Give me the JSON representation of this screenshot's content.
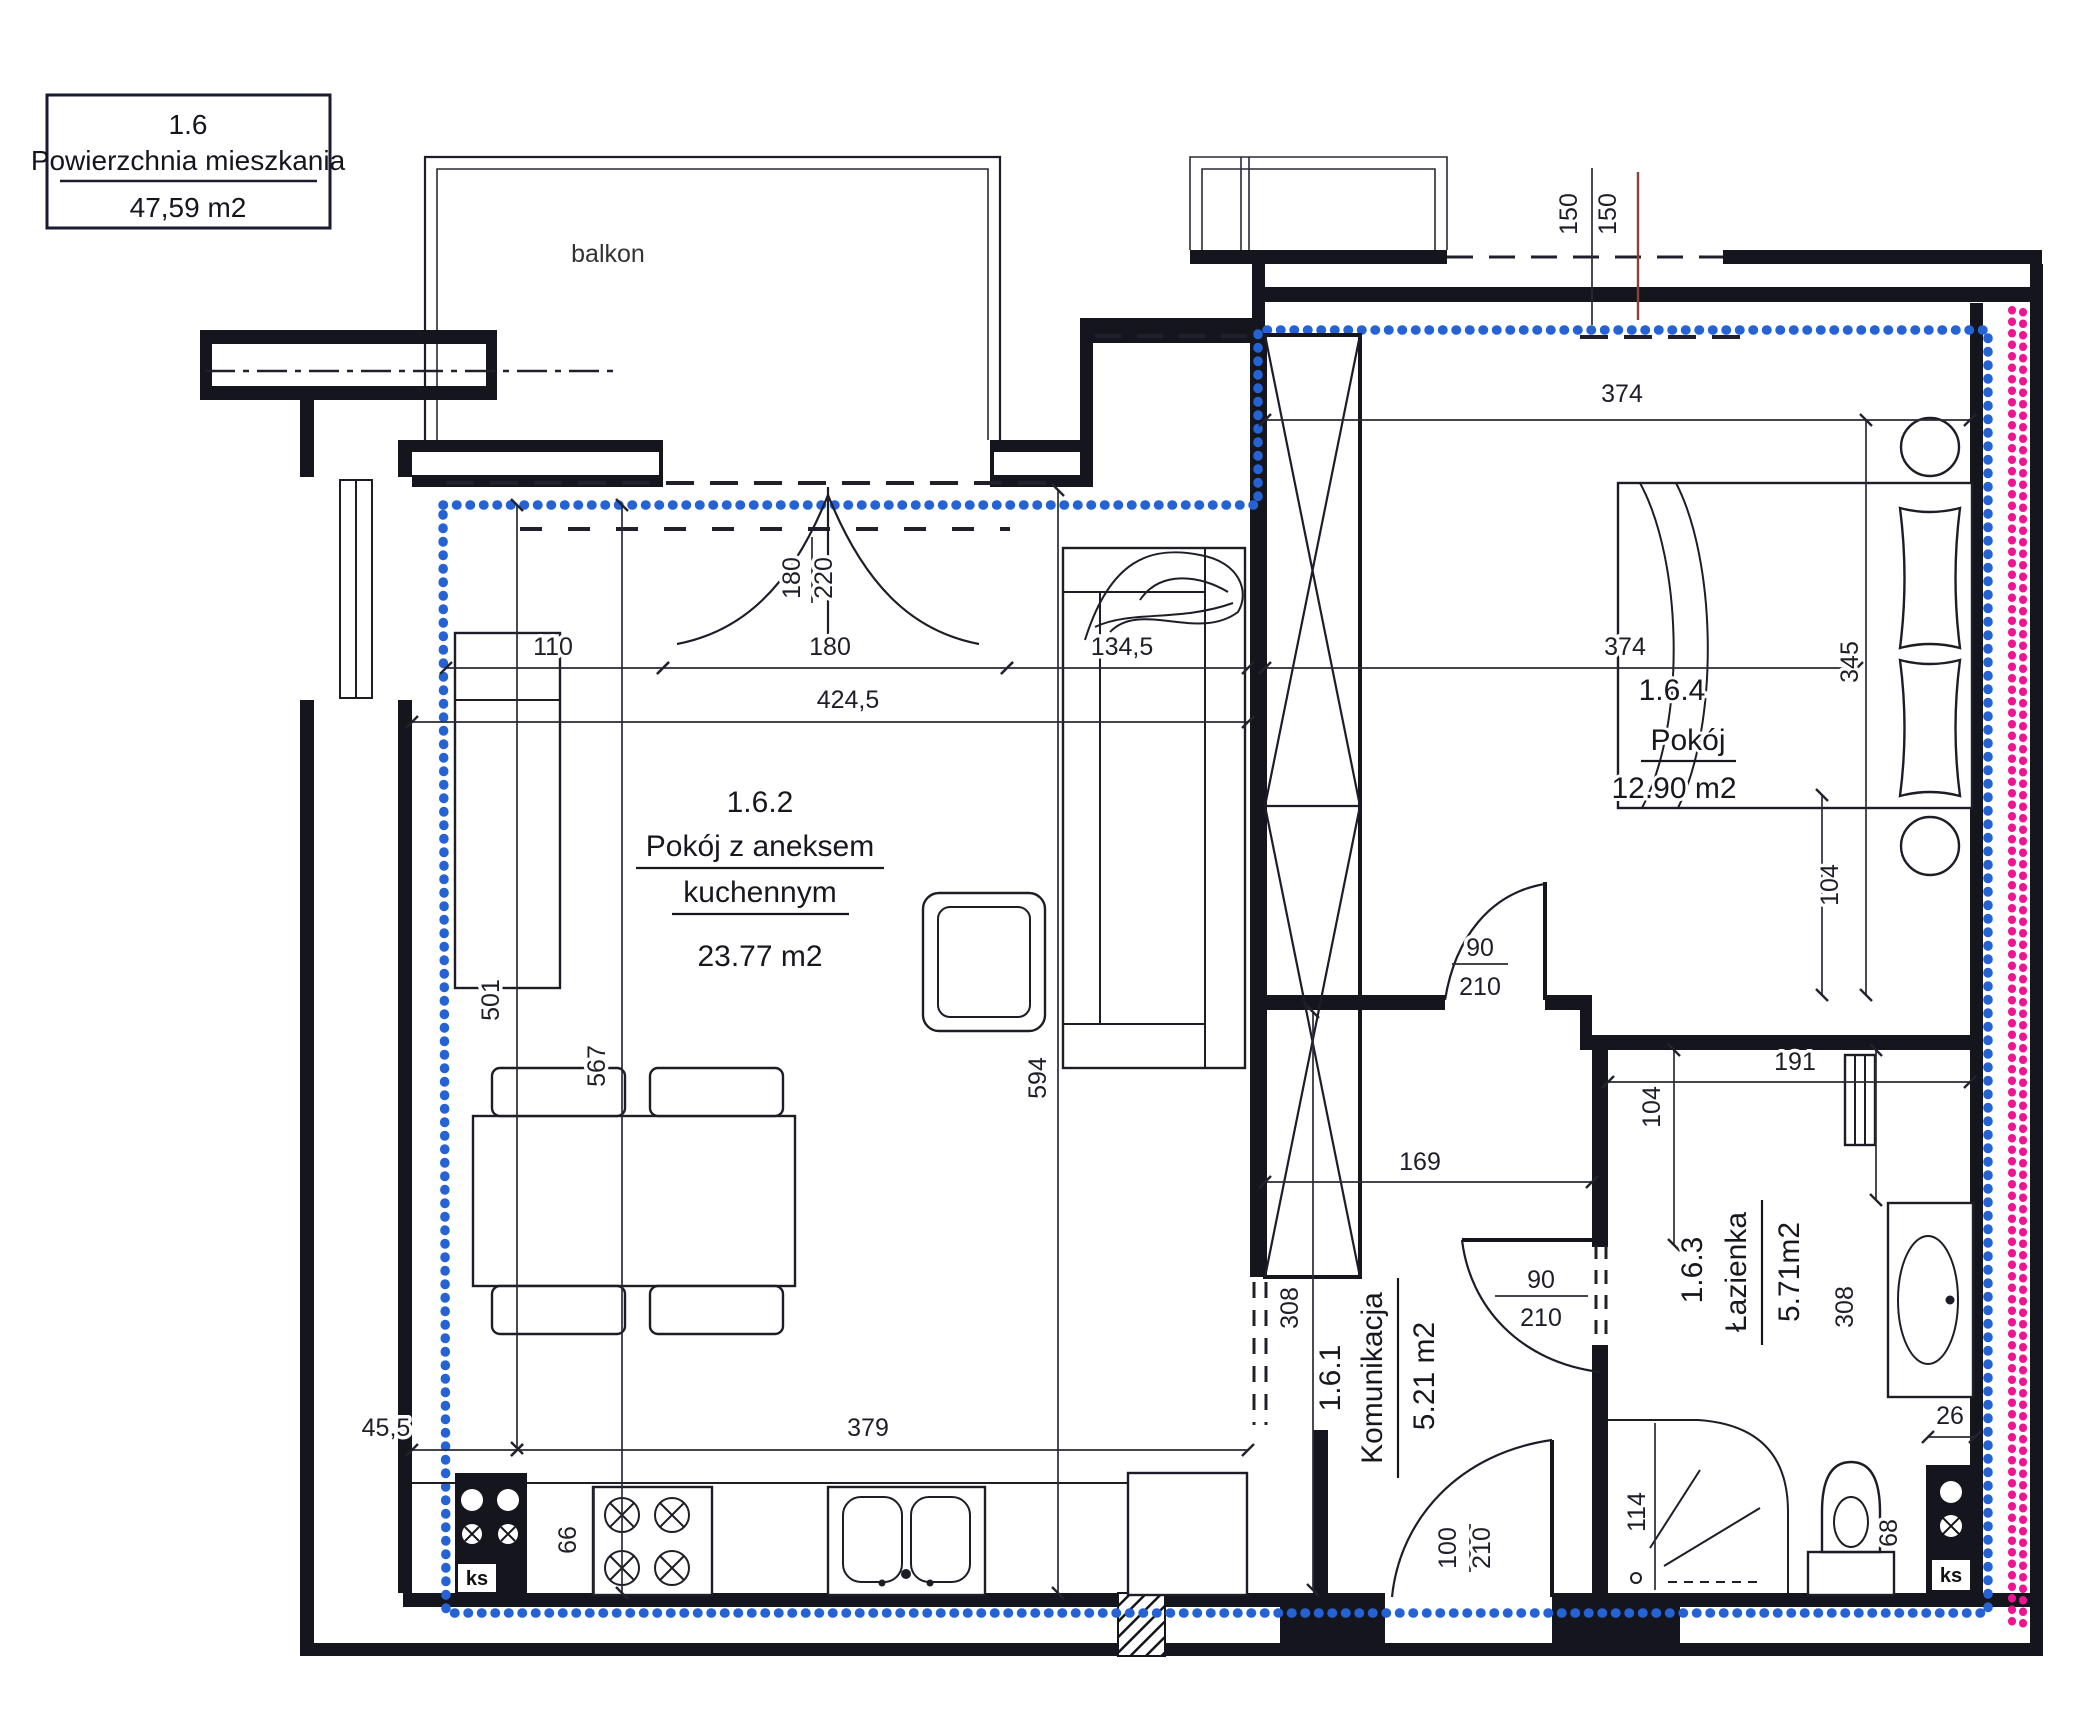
{
  "info_box": {
    "unit": "1.6",
    "label": "Powierzchnia mieszkania",
    "area": "47,59 m2"
  },
  "balcony": {
    "label": "balkon"
  },
  "rooms": {
    "living": {
      "id": "1.6.2",
      "name1": "Pokój z aneksem",
      "name2": "kuchennym",
      "area": "23.77 m2"
    },
    "bedroom": {
      "id": "1.6.4",
      "name": "Pokój",
      "area": "12.90 m2"
    },
    "hall": {
      "id": "1.6.1",
      "name": "Komunikacja",
      "area": "5.21 m2"
    },
    "bathroom": {
      "id": "1.6.3",
      "name": "Łazienka",
      "area": "5.71m2"
    }
  },
  "dimensions": {
    "window_150_left": "150",
    "window_150_right": "150",
    "bedroom_width_top": "374",
    "bedroom_width_mid": "374",
    "bedroom_depth": "345",
    "bed_gap": "104",
    "balcony_door_w": "180",
    "balcony_door_h": "220",
    "living_width": "424,5",
    "balcony_door_opening": "180",
    "kitchen_run": "110",
    "sofa_zone": "134,5",
    "living_depth": "594",
    "living_depth_left": "501",
    "living_depth_mid": "567",
    "counter_span": "379",
    "corner_gap": "45,5",
    "stove_width": "66",
    "hall_width": "169",
    "hall_depth": "308",
    "bath_width": "191",
    "bath_jamb": "104",
    "bath_depth": "308",
    "shaft_width": "26",
    "shower_width": "114",
    "toilet_width": "68",
    "bedroom_door_w": "90",
    "bedroom_door_h": "210",
    "bath_door_w": "90",
    "bath_door_h": "210",
    "entry_door_w": "100",
    "entry_door_h": "210"
  },
  "fixtures": {
    "ks_kitchen": "ks",
    "ks_bath": "ks"
  },
  "colors": {
    "boundary_blue": "#2563d4",
    "boundary_pink": "#ee1492",
    "wall": "#15151d"
  }
}
